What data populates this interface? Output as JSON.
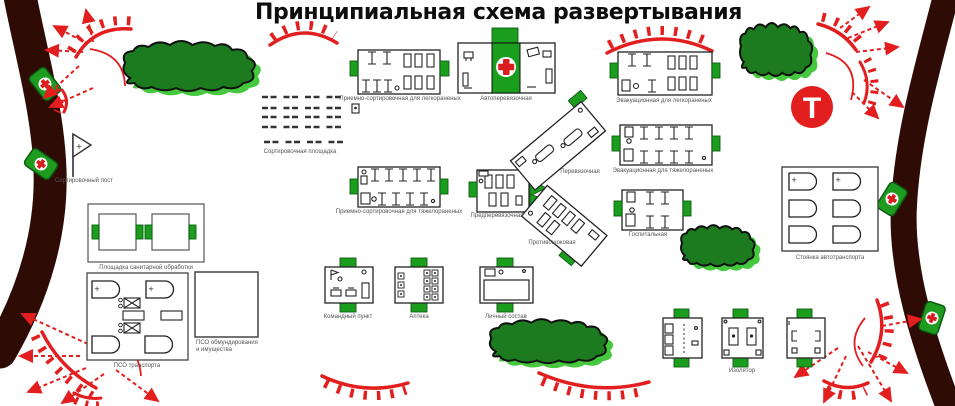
{
  "title": "Принципиальная схема развертывания",
  "symbols": {
    "plus": "+",
    "t_sign": "Т"
  },
  "facilities": {
    "sort_post": "Сортировочный пост",
    "san_area": "Площадка санитарной обработки",
    "pso_transport": "ПСО транспорта",
    "pso_equipment": "ПСО обмундирования и имущества",
    "sort_area": "Сортировочная площадка",
    "reception_light": "Приемно-сортировочная для легкораненых",
    "auto_dressing": "Автоперевязочная",
    "evac_light": "Эвакуационная для легкораненых",
    "reception_heavy": "Приемно-сортировочная для тяжелораненых",
    "pre_dressing": "Предперевязочная",
    "dressing": "Перевязочная",
    "antishock": "Противошоковая",
    "evac_heavy": "Эвакуационная для тяжелораненых",
    "hospital": "Госпитальная",
    "parking": "Стоянка автотранспорта",
    "command_post": "Командный пункт",
    "pharmacy": "Аптека",
    "personnel": "Личный состав",
    "isolator": "Изолятор"
  },
  "colors": {
    "red": "#e31e1e",
    "entrance_green": "#1b9e1e",
    "tree_dark": "#1c7b1e",
    "tree_light": "#45c83d",
    "road_dark": "#2e0b05",
    "label_gray": "#555555"
  }
}
